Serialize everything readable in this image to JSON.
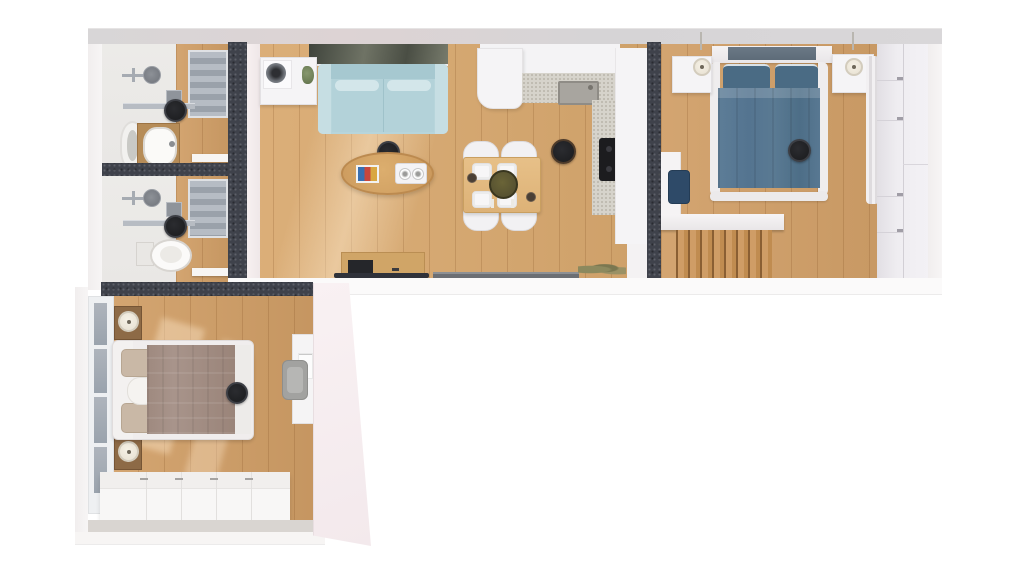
{
  "scene": {
    "type": "3d-floor-plan-top-down-render",
    "background": "#ffffff",
    "palette": {
      "wall_dark": "#3f424b",
      "exterior": "#f4f2f2",
      "wood": "#d09e66",
      "tile": "#e9e7e5",
      "counter_speckle": "#d6d3cb",
      "glass": "#9aa3ad",
      "sofa": "#b7d5db",
      "bed_main_duvet": "#547490",
      "bed_second_duvet": "#a8948b",
      "table_wood": "#ddb277",
      "bowl_olive": "#4f4a2e",
      "navy_chair": "#2e4a68",
      "ceiling_lamp": "#1a1b1d"
    },
    "counts": {
      "ceiling_lamps": 6,
      "bathrooms": 2,
      "bedrooms": 2,
      "dining_chairs": 4,
      "dining_plates": 4
    },
    "rooms": {
      "bathroom_top": {
        "name": "Bathroom",
        "furniture": [
          "shower enclosure",
          "rain shower head",
          "wall mixer",
          "soap shelf",
          "glass screen",
          "vanity with basin",
          "tall mirror cabinet",
          "ceiling lamp",
          "door leaf"
        ]
      },
      "bathroom_bottom": {
        "name": "Bathroom",
        "furniture": [
          "shower enclosure",
          "rain shower head",
          "wall mixer",
          "soap shelf",
          "glass screen",
          "toilet",
          "ceiling lamp",
          "door leaf"
        ]
      },
      "living_room": {
        "name": "Living room",
        "furniture": [
          "wall picture",
          "media cabinet",
          "speaker",
          "plant",
          "two-seat sofa",
          "two seat pillows",
          "oval coffee table",
          "book",
          "tray with two cups",
          "tv sideboard",
          "tv",
          "ceiling lamp",
          "bottom window"
        ]
      },
      "kitchen_dining": {
        "name": "Kitchen & dining",
        "furniture": [
          "upper cabinets",
          "tall cabinet column",
          "speckled countertop",
          "sink",
          "cooktop",
          "cabinet fronts",
          "floor plant",
          "dining table",
          "four chairs",
          "four plates",
          "olive bowl",
          "two glasses",
          "ceiling lamp"
        ]
      },
      "bedroom_main": {
        "name": "Main bedroom",
        "furniture": [
          "canopy headboard",
          "double bed",
          "two pillows",
          "denim duvet",
          "two nightstands",
          "two table lamps",
          "curtain",
          "tall wardrobe",
          "desk panel",
          "navy chair",
          "stair railing",
          "staircase",
          "ceiling lamp"
        ]
      },
      "bedroom_second": {
        "name": "Second bedroom",
        "furniture": [
          "window wall",
          "double bed",
          "two pillows",
          "rolled blanket",
          "taupe duvet",
          "two wooden nightstands",
          "two table lamps",
          "desk with poster",
          "grey chair",
          "low wardrobe row",
          "ceiling lamp"
        ]
      }
    }
  }
}
